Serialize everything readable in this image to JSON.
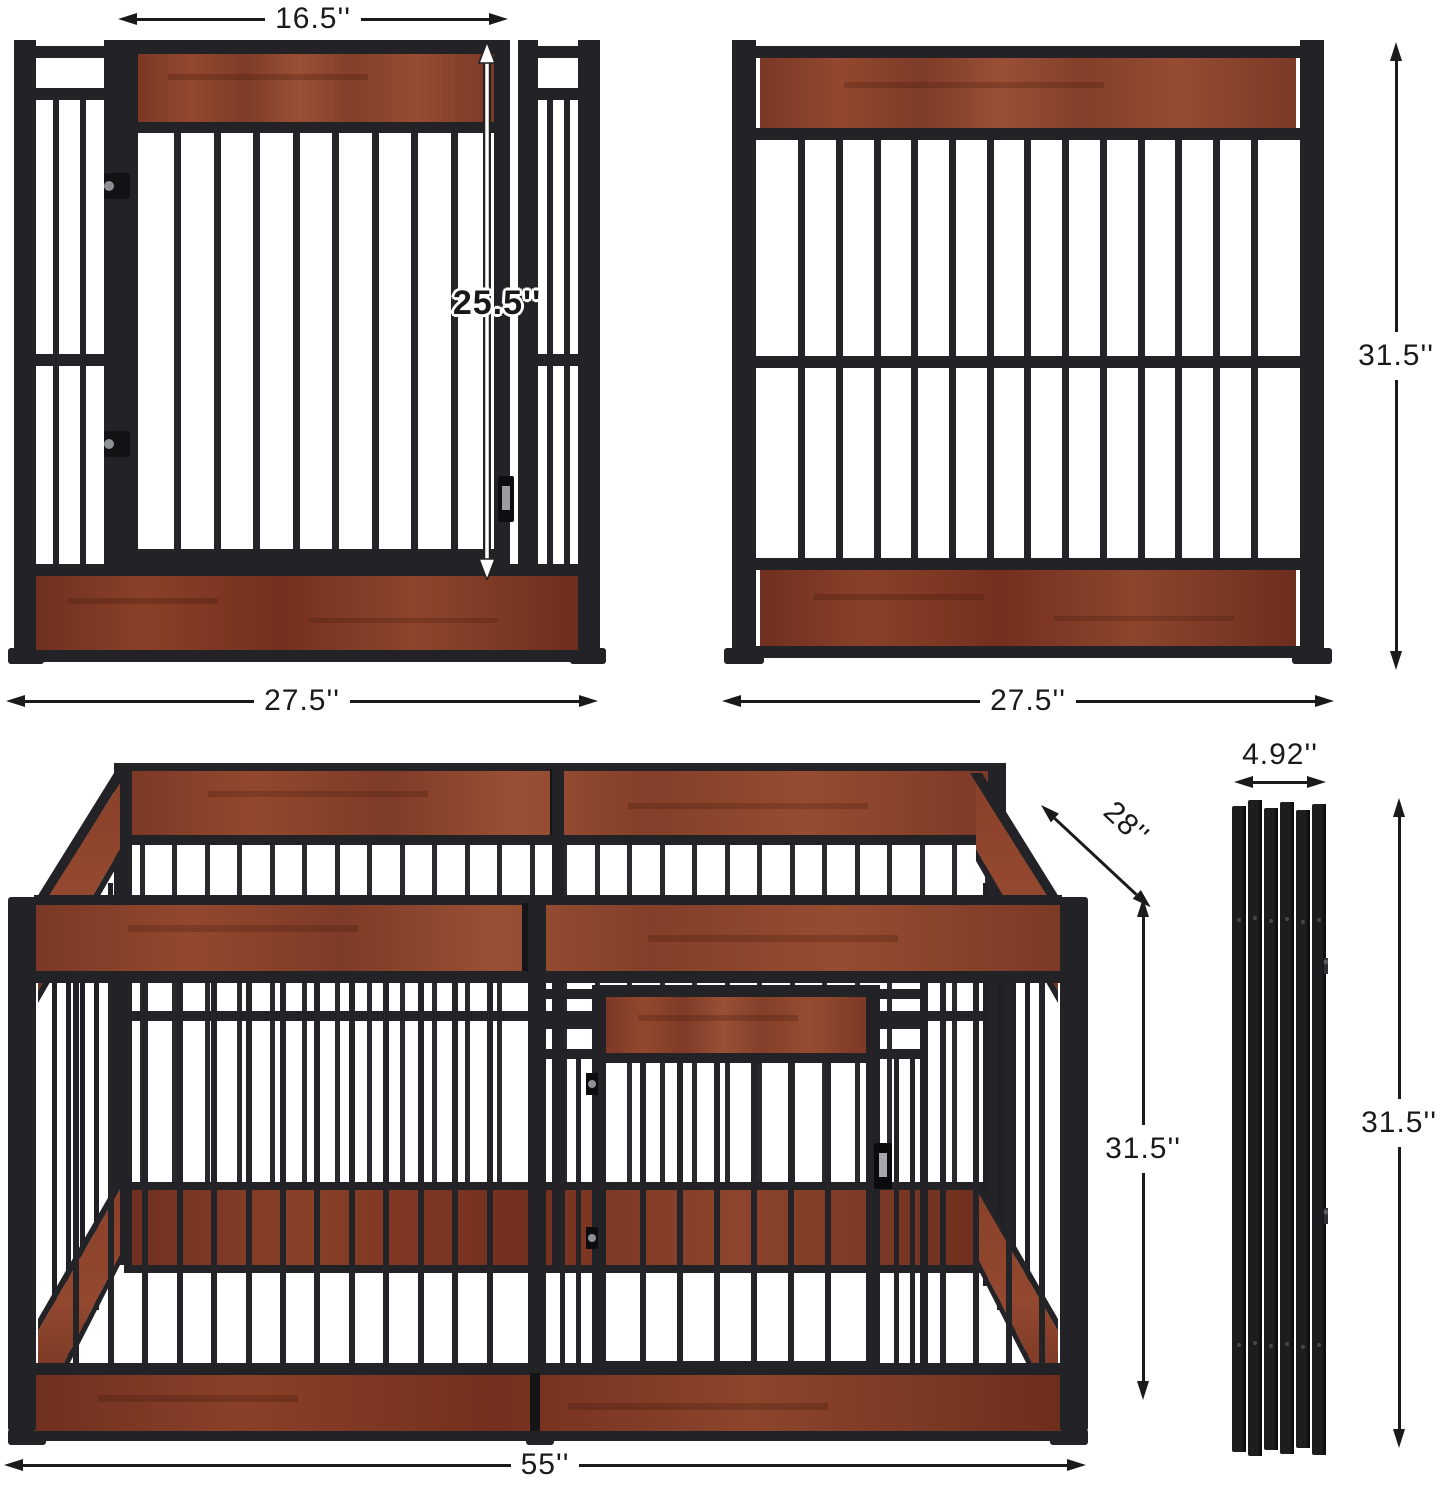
{
  "diagram": {
    "units": "inches",
    "colors": {
      "metal": "#232327",
      "wood": "#8f4732",
      "wood_dark": "#6f3120",
      "annotation": "#1a1a1a",
      "background": "#ffffff"
    },
    "views": {
      "front_panel": {
        "label": "front panel with door",
        "dims": {
          "door_width": "16.5''",
          "door_height": "25.5''",
          "width": "27.5''"
        }
      },
      "side_panel": {
        "label": "side panel",
        "dims": {
          "height": "31.5''",
          "width": "27.5''"
        }
      },
      "assembled_pen": {
        "label": "assembled playpen",
        "dims": {
          "depth": "28''",
          "height": "31.5''",
          "width": "55''"
        }
      },
      "folded_panels": {
        "label": "folded panels stack",
        "dims": {
          "width": "4.92''",
          "height": "31.5''"
        }
      }
    }
  }
}
